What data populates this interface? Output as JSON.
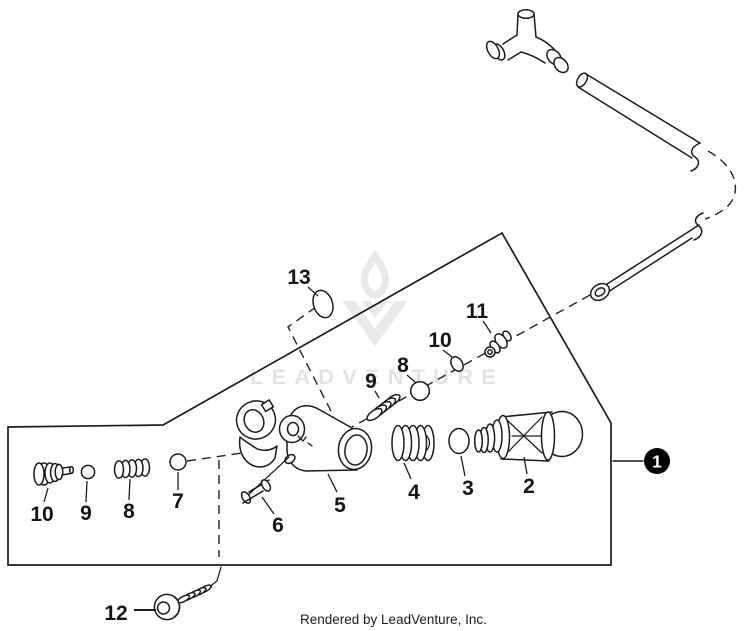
{
  "diagram": {
    "type": "exploded-parts-diagram",
    "watermark_text": "LEADVENTURE",
    "footer_credit": "Rendered by LeadVenture, Inc.",
    "parts": [
      {
        "num": "1"
      },
      {
        "num": "2"
      },
      {
        "num": "3"
      },
      {
        "num": "4"
      },
      {
        "num": "5"
      },
      {
        "num": "6"
      },
      {
        "num": "7"
      },
      {
        "num": "8"
      },
      {
        "num": "9"
      },
      {
        "num": "10"
      },
      {
        "num": "11"
      },
      {
        "num": "12"
      },
      {
        "num": "13"
      }
    ],
    "colors": {
      "line": "#1c1c1c",
      "label": "#151515",
      "watermark": "#e5e5e5",
      "callout_bg": "#000000",
      "callout_fg": "#ffffff",
      "background": "#ffffff"
    }
  }
}
